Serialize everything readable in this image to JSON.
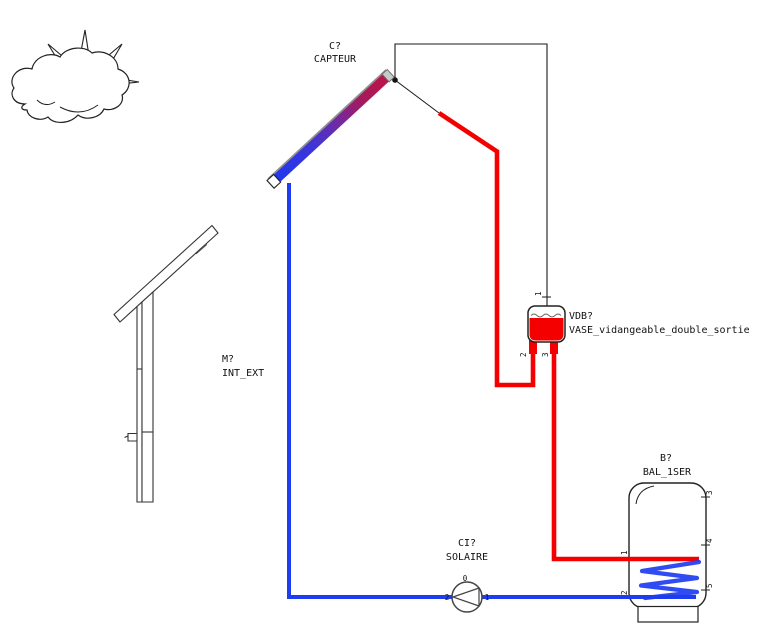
{
  "diagram": {
    "colors": {
      "hot_pipe": "#f40000",
      "cold_pipe": "#1e3cf0",
      "line": "#1a1a1a",
      "collector_gradient": [
        "#1c38f2",
        "#3f35d5",
        "#6f2aa6",
        "#a31a5e",
        "#c11244"
      ]
    },
    "sun_cloud_icon": "sun-behind-cloud-sketch",
    "collector": {
      "id_label": "C?",
      "type_label": "CAPTEUR"
    },
    "mast": {
      "id_label": "M?",
      "type_label": "INT_EXT"
    },
    "vessel": {
      "id_label": "VDB?",
      "type_label": "VASE_vidangeable_double_sortie",
      "ports": {
        "top": "1",
        "bottom_left": "2",
        "bottom_right": "3"
      }
    },
    "pump": {
      "id_label": "CI?",
      "type_label": "SOLAIRE",
      "ports": {
        "top": "0",
        "left": "2",
        "right": "1"
      }
    },
    "tank": {
      "id_label": "B?",
      "type_label": "BAL_1SER",
      "ports": {
        "left_top": "1",
        "left_bottom": "2",
        "right_top": "3",
        "right_mid": "4",
        "right_bottom": "5"
      }
    }
  }
}
